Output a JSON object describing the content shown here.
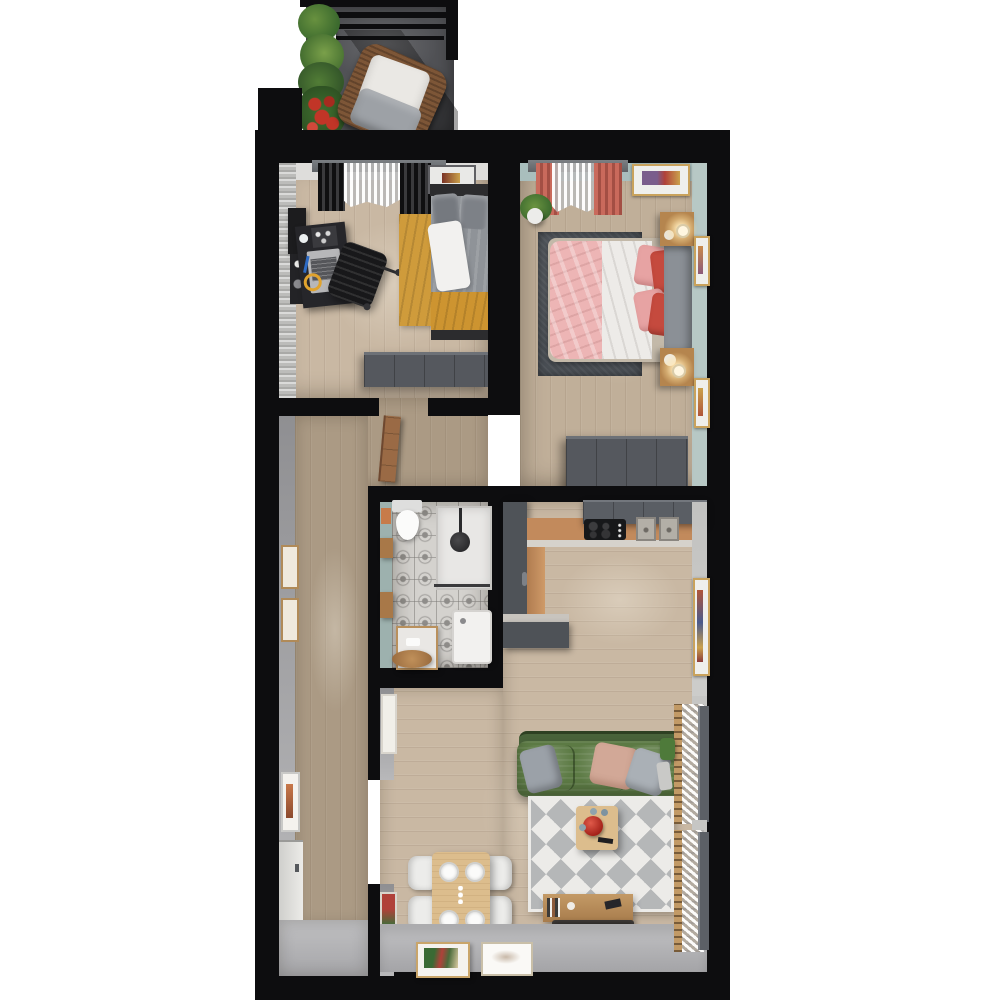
{
  "scene": {
    "type": "3d-floorplan-top-down-render",
    "description": "Top-down 3D render of an apartment: balcony with lounge chair and planters, home office bedroom, master bedroom, hallway, bathroom, kitchen and open living-dining room",
    "background": "#ffffff"
  },
  "colors": {
    "bg": "#ffffff",
    "wall": "#0d0d0f",
    "wood_light": "#c9b8a3",
    "wood_mid": "#c0af99",
    "wood_dark": "#ab9a84",
    "floor_gray": "#b4b4b7",
    "wall_gray_light": "#dedddb",
    "wall_gray_mid": "#a1a1a3",
    "wallpaper": "#bcbcba",
    "wall_teal": "#a9bebd",
    "wall_teal_light": "#b7c8c5",
    "wardrobe_gray": "#55585e",
    "cabinet_dark": "#4f5358",
    "counter_wood": "#c28a5c",
    "rug_yellow": "#cf9b3b",
    "rug_dark": "#4c5157",
    "rug_white": "#ecebe8",
    "rug_chevron": "#b5b7b8",
    "sofa_green": "#5d7b45",
    "sofa_green_dark": "#49633a",
    "bed_pink": "#edb5b5",
    "bed_white": "#edebe8",
    "pillow_red": "#c54a3e",
    "pillow_pink": "#e7a3a3",
    "headboard_gray": "#8b9096",
    "bed1_gray": "#8f9398",
    "blanket_mustard": "#cd9430",
    "curtain_coral": "#c96a5c",
    "tile_base": "#d4d2ce",
    "tile_accent": "#8f8d8a",
    "wood_furniture": "#b5854e",
    "table_wood": "#dcbd8d",
    "chair_white": "#ececea",
    "tv_dark": "#26221f",
    "balcony_floor": "#515256",
    "chair_rattan": "#7d5637",
    "plant_green": "#527d36",
    "flower_red": "#c13527",
    "frame_gold": "#c9a25c",
    "door_wood": "#9a6a45",
    "glow_warm": "#ffe9b8",
    "appliance_white": "#f2f1ef",
    "steel": "#b3afa7"
  },
  "rooms": [
    {
      "id": "balcony",
      "label": "balcony"
    },
    {
      "id": "office-bedroom",
      "label": "office bedroom"
    },
    {
      "id": "master-bedroom",
      "label": "master bedroom"
    },
    {
      "id": "hallway",
      "label": "hallway"
    },
    {
      "id": "bathroom",
      "label": "bathroom"
    },
    {
      "id": "kitchen",
      "label": "kitchen"
    },
    {
      "id": "living-dining",
      "label": "living and dining room"
    },
    {
      "id": "entryway",
      "label": "entryway"
    }
  ],
  "furniture": {
    "balcony": [
      "railing",
      "plant-wall",
      "red-flowers",
      "rattan-lounge-chair"
    ],
    "office_bedroom": [
      "window-black-curtains",
      "wall-shelf",
      "desk-with-laptop",
      "office-chair",
      "mustard-rug",
      "single-bed-gray",
      "mustard-blanket",
      "wardrobe"
    ],
    "master_bedroom": [
      "window-coral-curtains",
      "wall-art",
      "potted-plant",
      "dark-rug",
      "double-bed-pink-white",
      "red-pink-pillows",
      "nightstand-lamp-top",
      "nightstand-lamp-bottom",
      "wardrobe"
    ],
    "bathroom": [
      "toilet",
      "shower",
      "washing-machine",
      "side-table",
      "round-wood-tray",
      "wall-shelves"
    ],
    "kitchen": [
      "tall-cabinet",
      "upper-cabinets",
      "wood-counter",
      "cooktop",
      "double-sink",
      "lower-counter"
    ],
    "living_dining": [
      "green-sofa",
      "throw-pillows",
      "chevron-rug",
      "coffee-table-red-kettle",
      "tv-console",
      "tv",
      "dining-table",
      "four-white-chairs",
      "leaning-art-frames",
      "two-windows-sheer-curtains",
      "watering-can"
    ],
    "hallway": [
      "wall-frames",
      "orange-art-frame",
      "front-door",
      "open-door-leaf"
    ]
  }
}
